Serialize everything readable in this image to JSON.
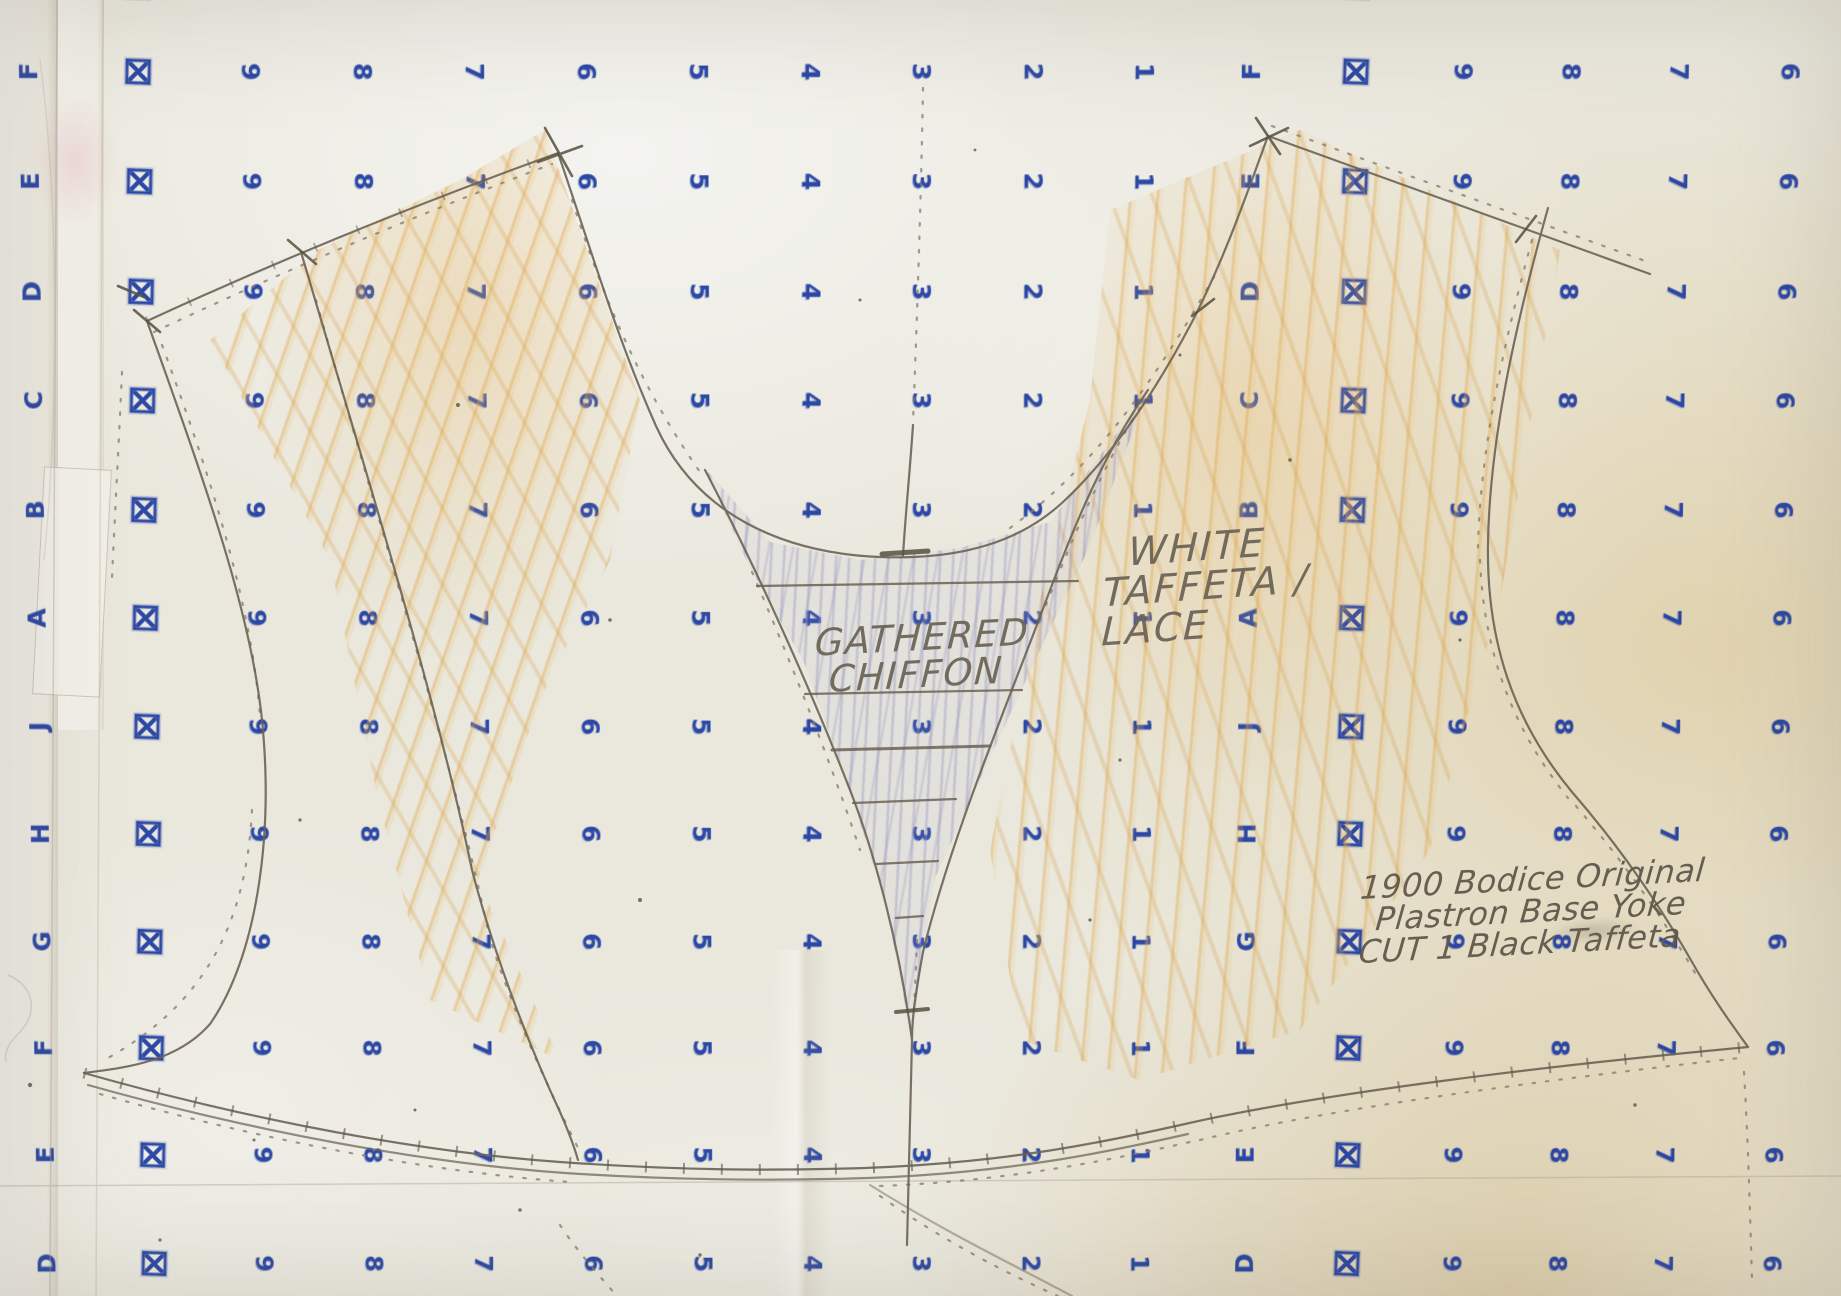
{
  "meta": {
    "description": "Photograph of a hand-drafted bodice sewing pattern on blue alphanumeric gridded pattern paper"
  },
  "annotations": {
    "gathered": [
      "GATHERED",
      "CHIFFON"
    ],
    "fabric": [
      "WHITE",
      "TAFFETA /",
      "LACE"
    ],
    "title": [
      "1900 Bodice Original",
      "Plastron Base Yoke",
      "CUT 1 Black Taffeta"
    ]
  },
  "grid": {
    "symbol": "boxed-x",
    "columns": [
      {
        "x": 36,
        "g": "letter"
      },
      {
        "x": 145,
        "g": "box"
      },
      {
        "x": 256,
        "g": "9"
      },
      {
        "x": 367,
        "g": "8"
      },
      {
        "x": 478,
        "g": "7"
      },
      {
        "x": 589,
        "g": "6"
      },
      {
        "x": 700,
        "g": "5"
      },
      {
        "x": 811,
        "g": "4"
      },
      {
        "x": 921,
        "g": "3"
      },
      {
        "x": 1032,
        "g": "2"
      },
      {
        "x": 1142,
        "g": "1"
      },
      {
        "x": 1248,
        "g": "letter"
      },
      {
        "x": 1352,
        "g": "box"
      },
      {
        "x": 1458,
        "g": "9"
      },
      {
        "x": 1565,
        "g": "8"
      },
      {
        "x": 1672,
        "g": "7"
      },
      {
        "x": 1782,
        "g": "6"
      }
    ],
    "rows": [
      -8,
      76,
      184,
      293,
      401,
      510,
      618,
      727,
      835,
      944,
      1052,
      1161,
      1272
    ],
    "row_letters": [
      "G",
      "F",
      "E",
      "D",
      "C",
      "B",
      "A",
      "J",
      "H",
      "G",
      "F",
      "E",
      "D"
    ]
  },
  "colors": {
    "paper": "#eae8dd",
    "grid_ink": "#1c3aa0",
    "pencil": "#6b6254",
    "pencil_text": "#6c6558",
    "crayon_orange": "#dfae62",
    "crayon_violet": "#9d9dc8"
  }
}
